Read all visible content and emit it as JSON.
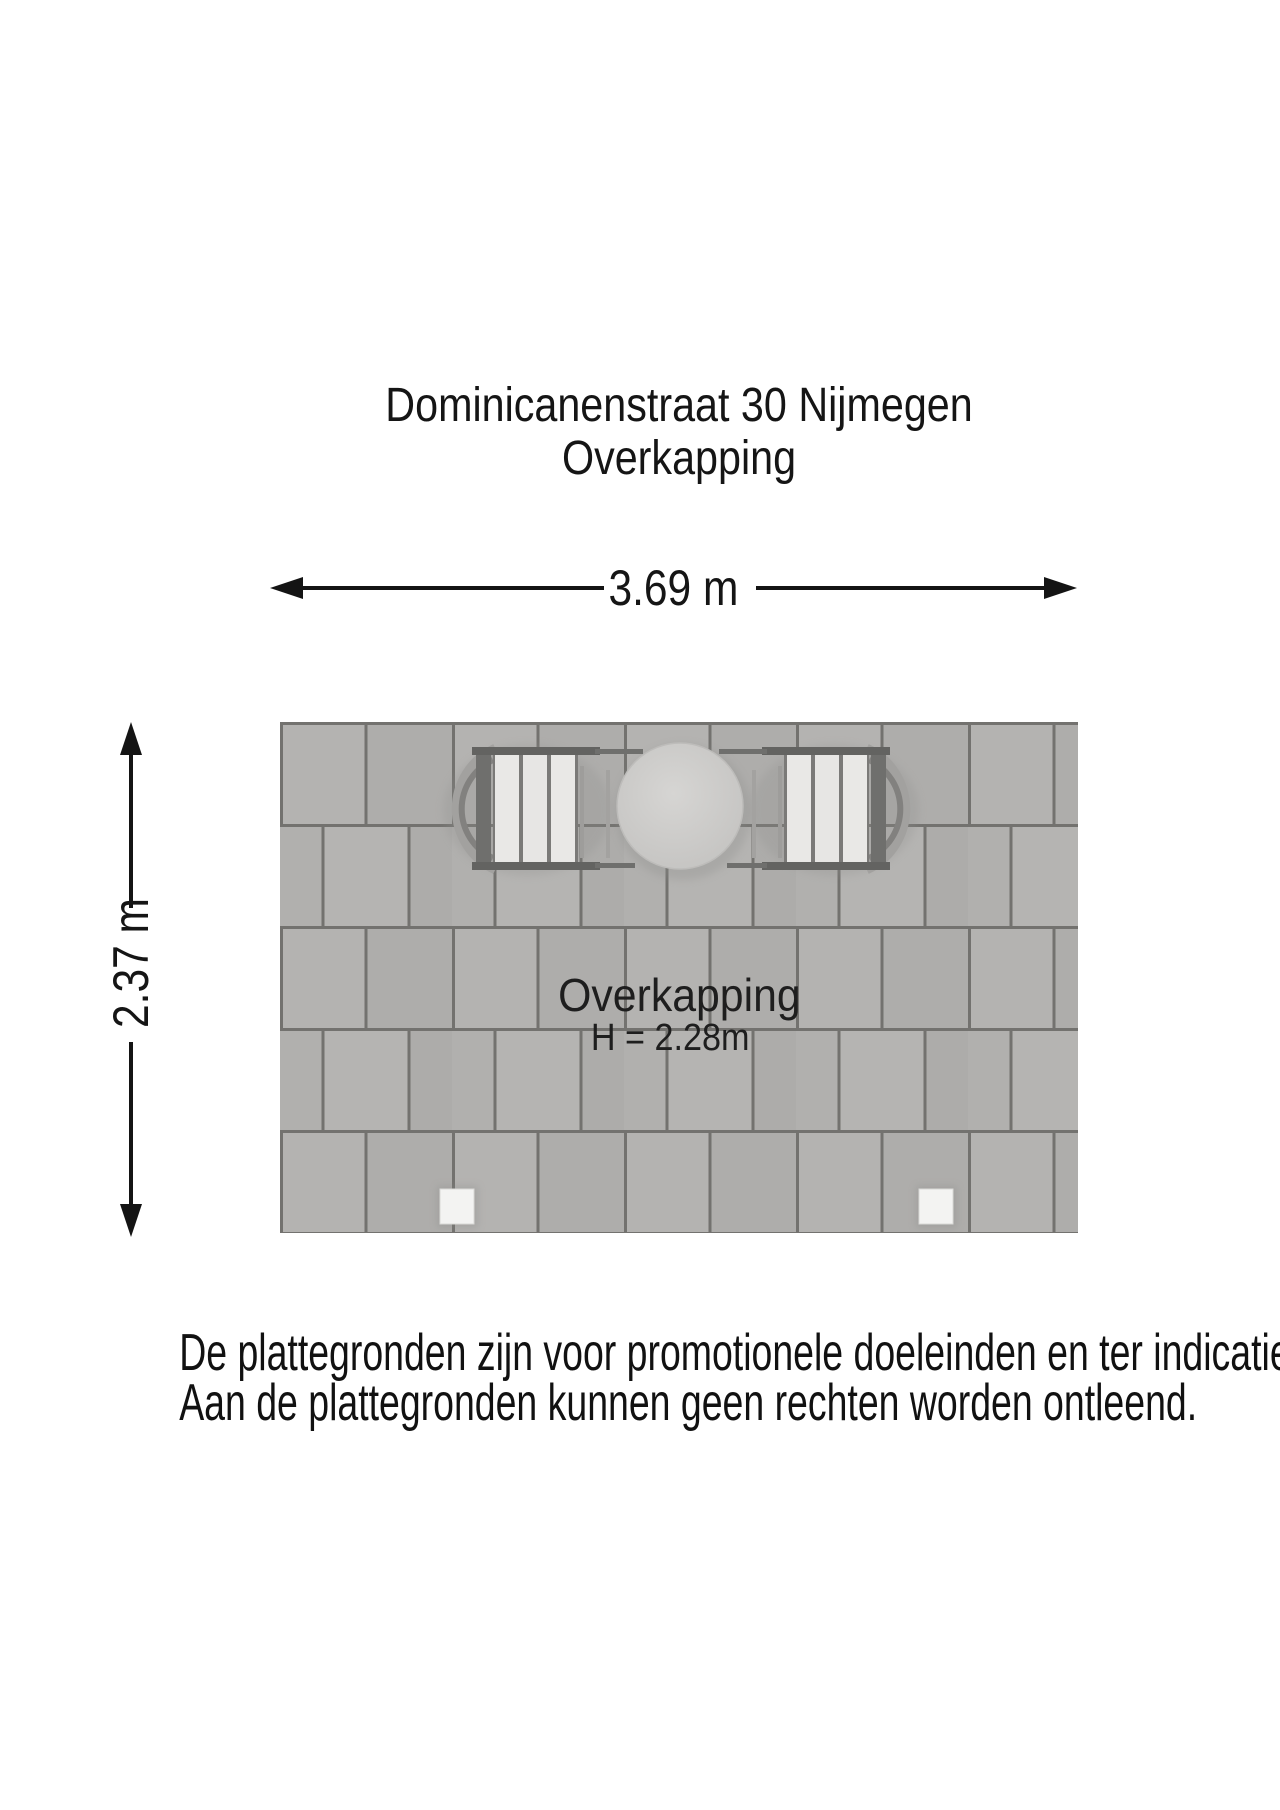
{
  "document": {
    "background_color": "#ffffff",
    "text_color": "#151515"
  },
  "title": {
    "line1": "Dominicanenstraat 30 Nijmegen",
    "line2": "Overkapping"
  },
  "dimensions": {
    "width": {
      "label": "3.69 m"
    },
    "height": {
      "label": "2.37 m"
    },
    "line_color": "#141414"
  },
  "plan": {
    "room_label": "Overkapping",
    "height_label": "H = 2.28m",
    "objects": [
      "chair-left",
      "round-table",
      "chair-right",
      "post-left",
      "post-right"
    ],
    "colors": {
      "paver": "#b1b0ae",
      "paver_light": "#b5b4b2",
      "paver_dark": "#aeadab",
      "joint": "#73726f",
      "table_top": "#cbcac8",
      "chair_slats": "#e8e7e5",
      "chair_frame": "#636361",
      "post": "#f3f3f2"
    }
  },
  "disclaimer": {
    "line1": "De plattegronden zijn voor promotionele doeleinden en ter indicatie.",
    "line2": "Aan de plattegronden kunnen geen rechten worden ontleend."
  }
}
